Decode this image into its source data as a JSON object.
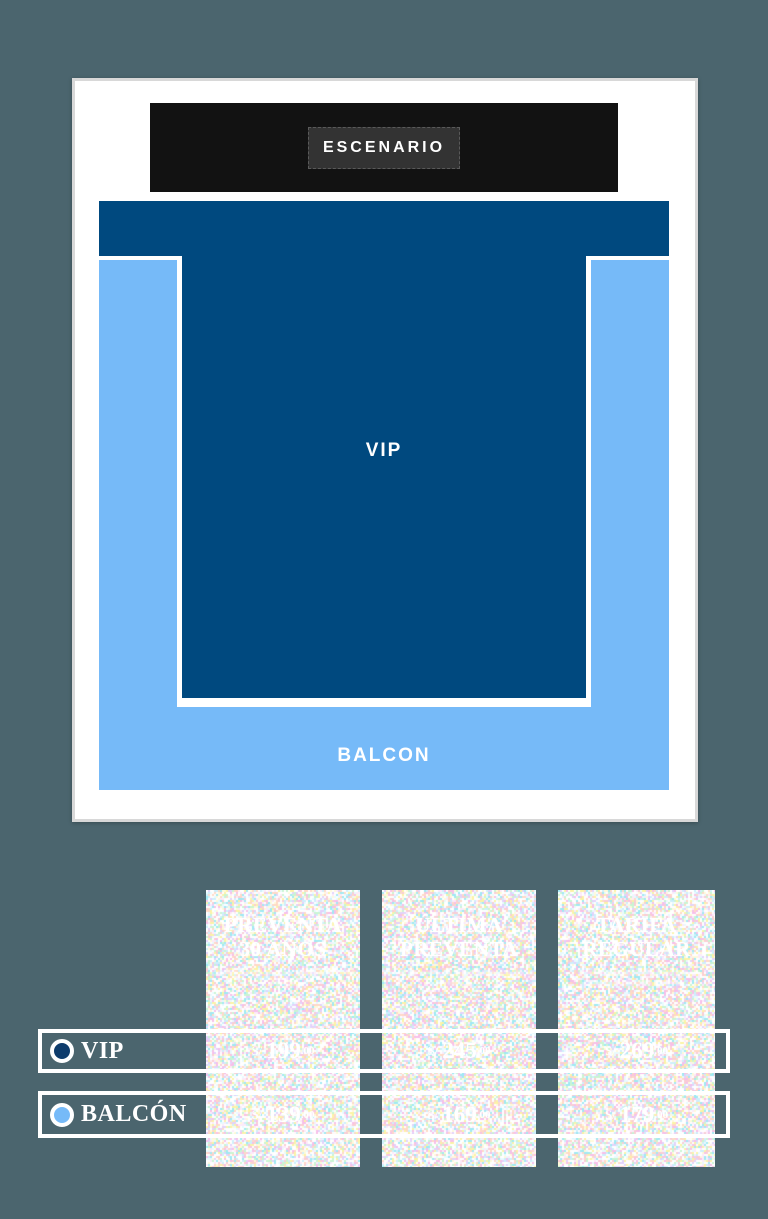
{
  "colors": {
    "page_bg": "#4b656e",
    "vip_blue": "#00497f",
    "balcon_blue": "#76baf8",
    "stage_black": "#121212",
    "stage_inner_gray": "#333333",
    "vip_marker": "#0e3c6c",
    "card_border": "#d8d8d8",
    "text_white": "#ffffff"
  },
  "venue_map": {
    "stage_label": "ESCENARIO",
    "vip_label": "VIP",
    "balcon_label": "BALCON"
  },
  "pricing": {
    "tiers": [
      {
        "title_line1": "PREVENTA",
        "title_line2": "30 AÑOS",
        "subtitle_line1": "VÁLIDA HASTA EL 30 DE ABRIL O AGOTAR STOCK",
        "subtitle_line2": ""
      },
      {
        "title_line1": "ÚLTIMA",
        "title_line2": "PREVENTA",
        "subtitle_line1": "DEL 01 DE MAYO AL 31 DE MAYO O AGOTAR STOCK",
        "subtitle_line2": ""
      },
      {
        "title_line1": "TARIFA",
        "title_line2": "REGULAR",
        "subtitle_line1": "PRECIOS REGULARES VIGENTES",
        "subtitle_line2": "HASTA EL DÍA DEL EVENTO"
      }
    ],
    "rows": [
      {
        "label": "VIP",
        "prices": [
          {
            "currency": "S/",
            "amount": "199",
            "cents": ".00"
          },
          {
            "currency": "S/",
            "amount": "245",
            "cents": ".00"
          },
          {
            "currency": "S/",
            "amount": "269",
            "cents": ".00"
          }
        ]
      },
      {
        "label": "BALCÓN",
        "prices": [
          {
            "currency": "S/",
            "amount": "139",
            "cents": ".00"
          },
          {
            "currency": "S/",
            "amount": "169",
            "cents": ".00"
          },
          {
            "currency": "S/",
            "amount": "179",
            "cents": ".00"
          }
        ]
      }
    ]
  }
}
